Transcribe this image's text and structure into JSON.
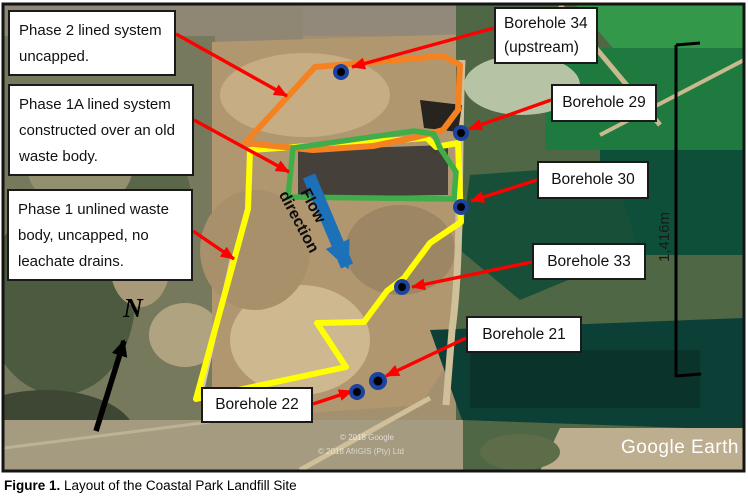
{
  "caption": {
    "prefix": "Figure 1.",
    "text": " Layout of the Coastal Park Landfill Site"
  },
  "annotations": {
    "phase2": "Phase 2 lined system uncapped.",
    "phase1a": "Phase 1A lined system constructed over an old waste body.",
    "phase1": "Phase 1 unlined waste body, uncapped, no leachate drains.",
    "borehole34_line1": "Borehole 34",
    "borehole34_line2": "(upstream)",
    "borehole29": "Borehole 29",
    "borehole30": "Borehole 30",
    "borehole33": "Borehole 33",
    "borehole21": "Borehole 21",
    "borehole22": "Borehole 22"
  },
  "map": {
    "flow_line1": "Flow",
    "flow_line2": "direction",
    "north_label": "N",
    "scale_label": "1,416m",
    "watermark": "Google Earth",
    "copyright_line1": "© 2018 Google",
    "copyright_line2": "© 2018 AfriGIS (Pty) Ltd"
  },
  "colors": {
    "phase2_outline": "#f58220",
    "phase1a_outline": "#3fae49",
    "phase1_outline": "#ffff00",
    "pointer_arrow": "#fe0000",
    "flow_arrow": "#1d71b8",
    "borehole_marker": "#1c43a0",
    "scale_bar": "#000000"
  }
}
